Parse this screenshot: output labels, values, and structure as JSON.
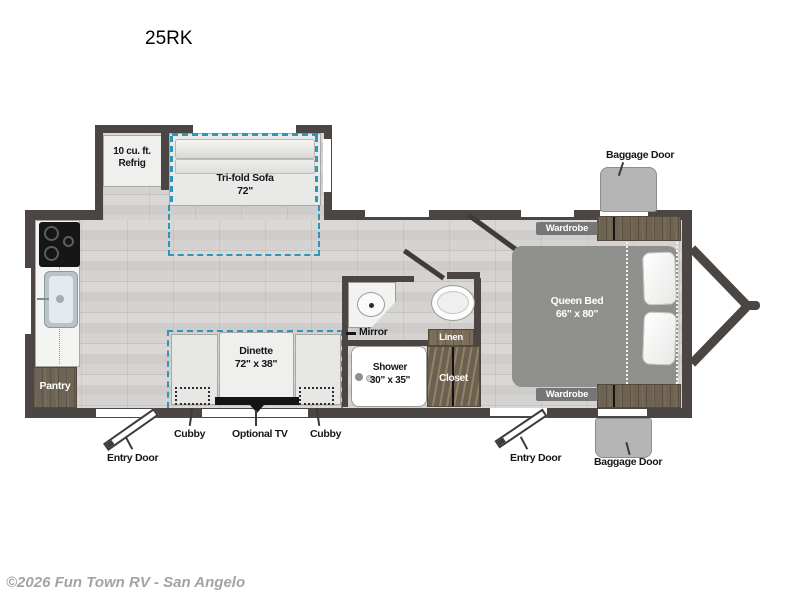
{
  "page": {
    "model": "25RK",
    "copyright": "©2026 Fun Town RV - San Angelo"
  },
  "floorplan": {
    "refrigerator": {
      "line1": "10 cu. ft.",
      "line2": "Refrig"
    },
    "sofa": {
      "line1": "Tri-fold Sofa",
      "line2": "72\""
    },
    "dinette": {
      "line1": "Dinette",
      "line2": "72\" x 38\""
    },
    "queen_bed": {
      "line1": "Queen Bed",
      "line2": "66\" x 80\""
    },
    "shower": {
      "line1": "Shower",
      "line2": "30\" x 35\""
    },
    "mirror": "Mirror",
    "linen": "Linen",
    "closet": "Closet",
    "pantry": "Pantry",
    "wardrobe_top": "Wardrobe",
    "wardrobe_bottom": "Wardrobe",
    "callouts": {
      "baggage_door_top": "Baggage Door",
      "baggage_door_bottom": "Baggage Door",
      "entry_door_left": "Entry Door",
      "entry_door_right": "Entry Door",
      "cubby_left": "Cubby",
      "cubby_right": "Cubby",
      "optional_tv": "Optional TV"
    }
  },
  "colors": {
    "wall": "#4b4643",
    "slide_accent": "#2e96b8",
    "cabinet_wood": "#6e6454",
    "bed": "#8f8f8c",
    "baggage_door_flap": "#b5b5b5",
    "footer_text": "#a3a3a3"
  }
}
